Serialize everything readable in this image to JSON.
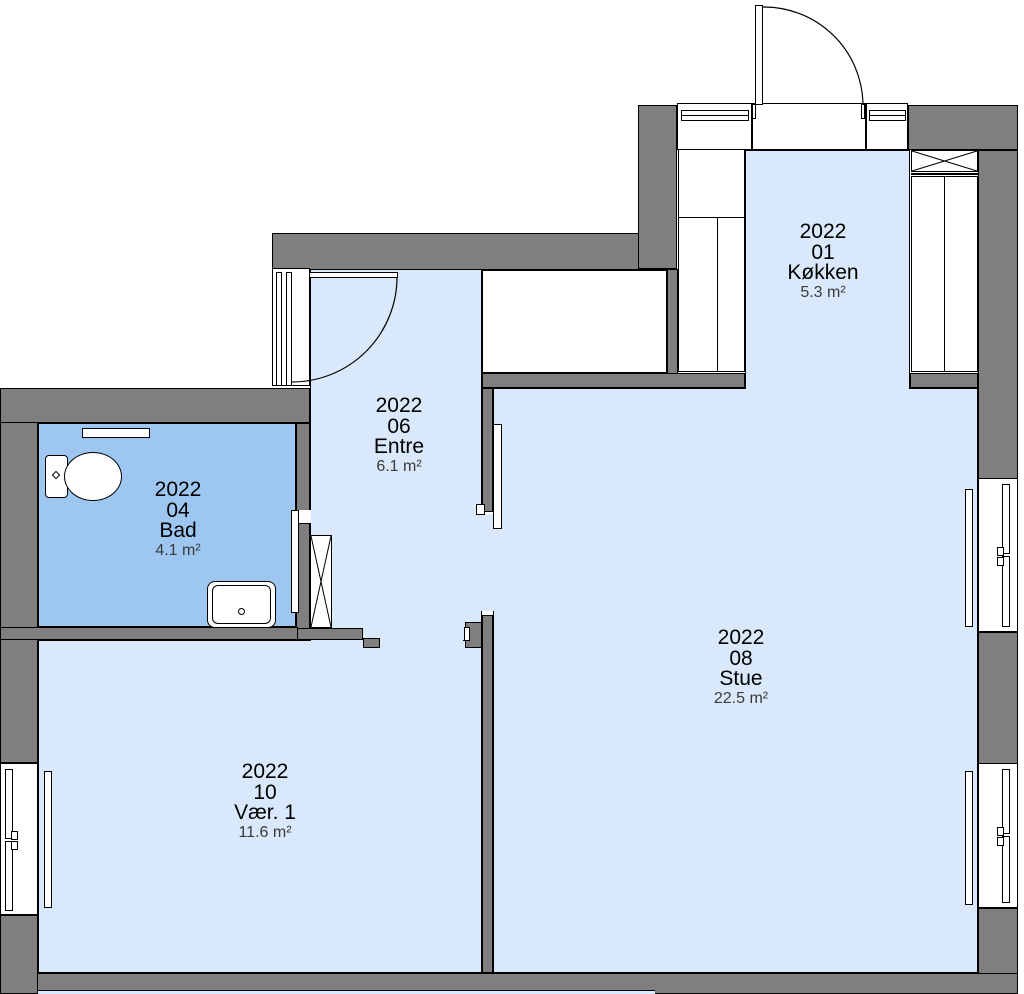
{
  "drawing_type": "apartment-floor-plan",
  "colors": {
    "wall": "#7f7f7f",
    "floor": "#d9e8fa",
    "bathroom_floor": "#9dc7f0",
    "outline": "#000000",
    "background": "#ffffff"
  },
  "rooms": [
    {
      "code": "2022",
      "number": "01",
      "name": "Køkken",
      "area": "5.3 m²"
    },
    {
      "code": "2022",
      "number": "06",
      "name": "Entre",
      "area": "6.1 m²"
    },
    {
      "code": "2022",
      "number": "04",
      "name": "Bad",
      "area": "4.1 m²"
    },
    {
      "code": "2022",
      "number": "08",
      "name": "Stue",
      "area": "22.5 m²"
    },
    {
      "code": "2022",
      "number": "10",
      "name": "Vær. 1",
      "area": "11.6 m²"
    }
  ]
}
